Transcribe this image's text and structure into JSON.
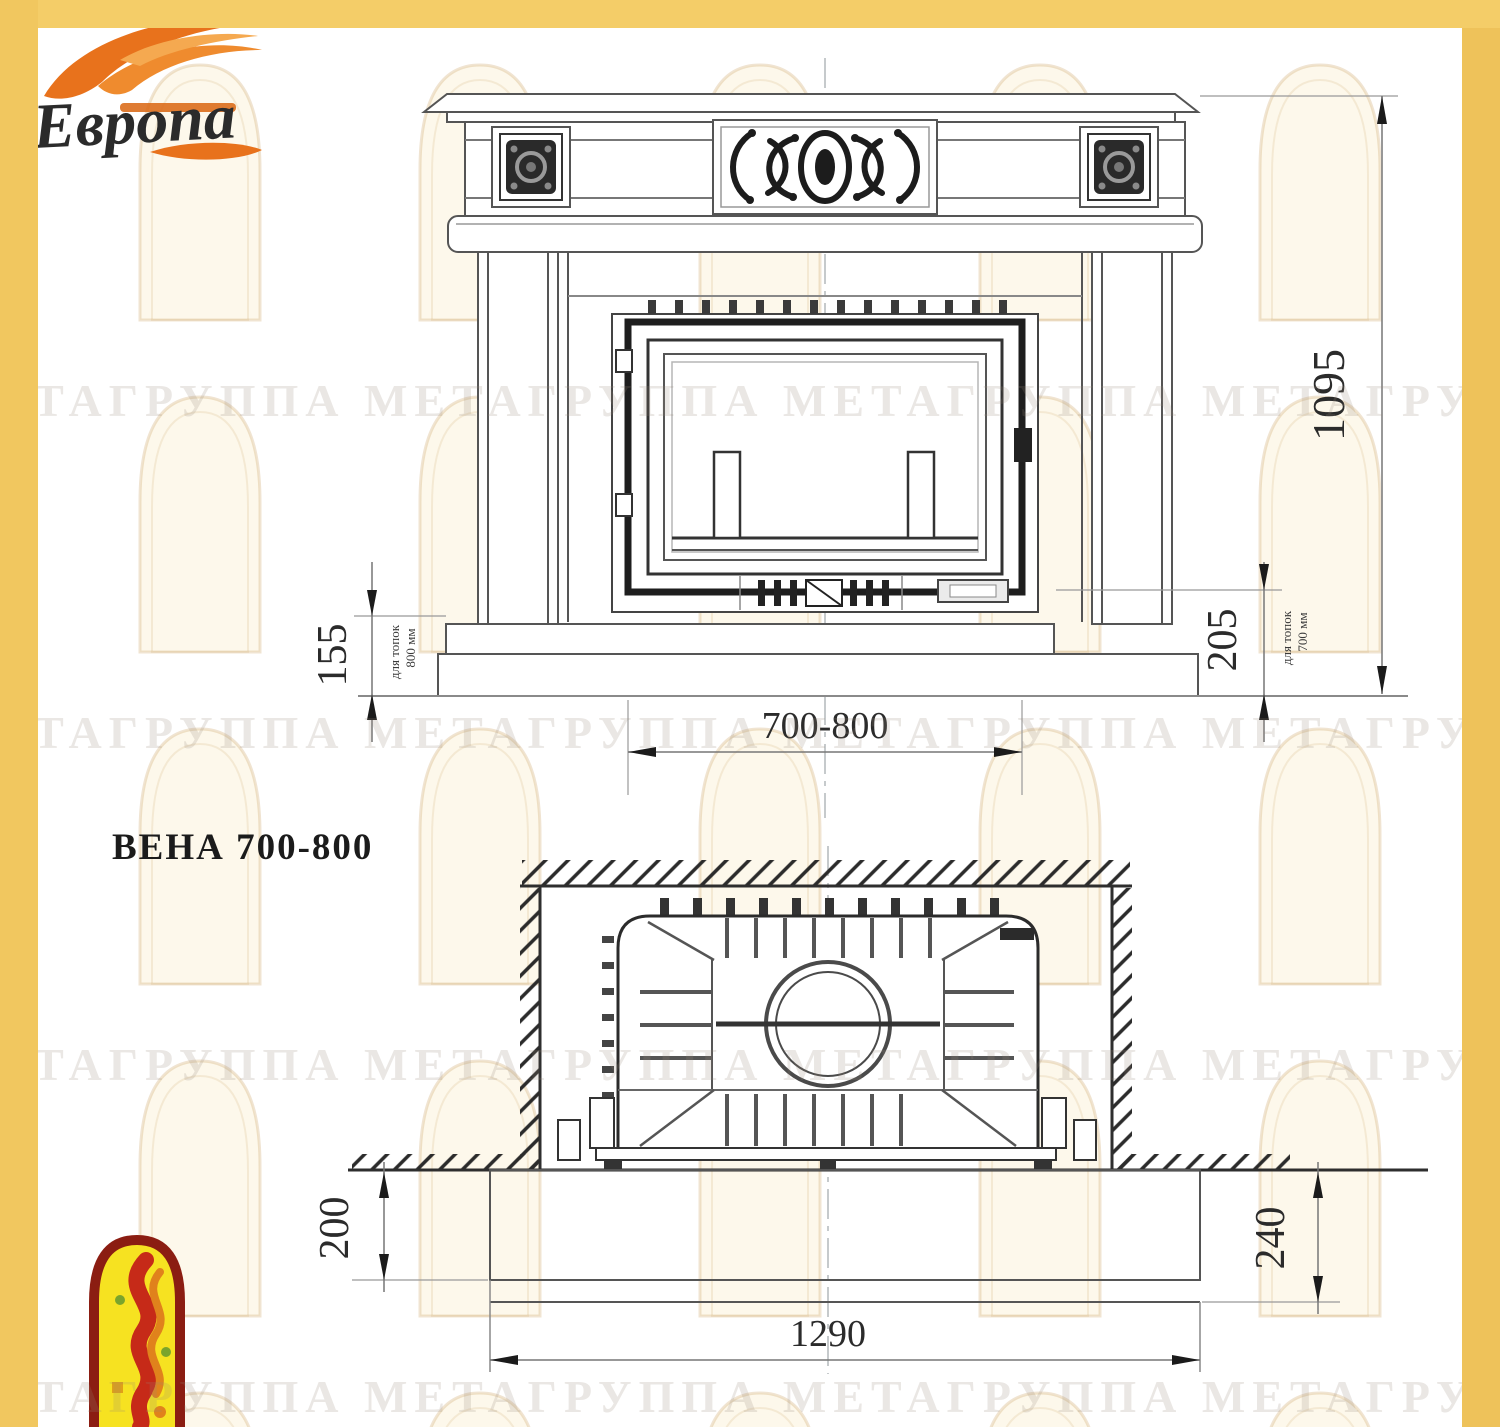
{
  "logo": {
    "name": "Европа"
  },
  "title": "ВЕНА 700-800",
  "front_view": {
    "dim_height": "1095",
    "dim_hearth_800": "155",
    "note_800_line1": "для топок",
    "note_800_line2": "800 мм",
    "dim_hearth_700": "205",
    "note_700_line1": "для топок",
    "note_700_line2": "700 мм",
    "dim_opening_width": "700-800"
  },
  "plan_view": {
    "dim_hearth_depth_front_left": "200",
    "dim_hearth_depth_front_right": "240",
    "dim_hearth_width": "1290"
  },
  "watermark": {
    "line": "МЕТАГРУППА МЕТАГРУППА МЕТАГРУППА МЕТАГРУППА МЕТА"
  },
  "colors": {
    "frame_gold": "#f1c75f",
    "logo_red": "#7e1b2d",
    "flame_orange": "#e87818",
    "emblem_yellow": "#f6e221",
    "emblem_border": "#8b1d12",
    "line_gray": "#555555",
    "dim_dark": "#1b1b1b"
  }
}
